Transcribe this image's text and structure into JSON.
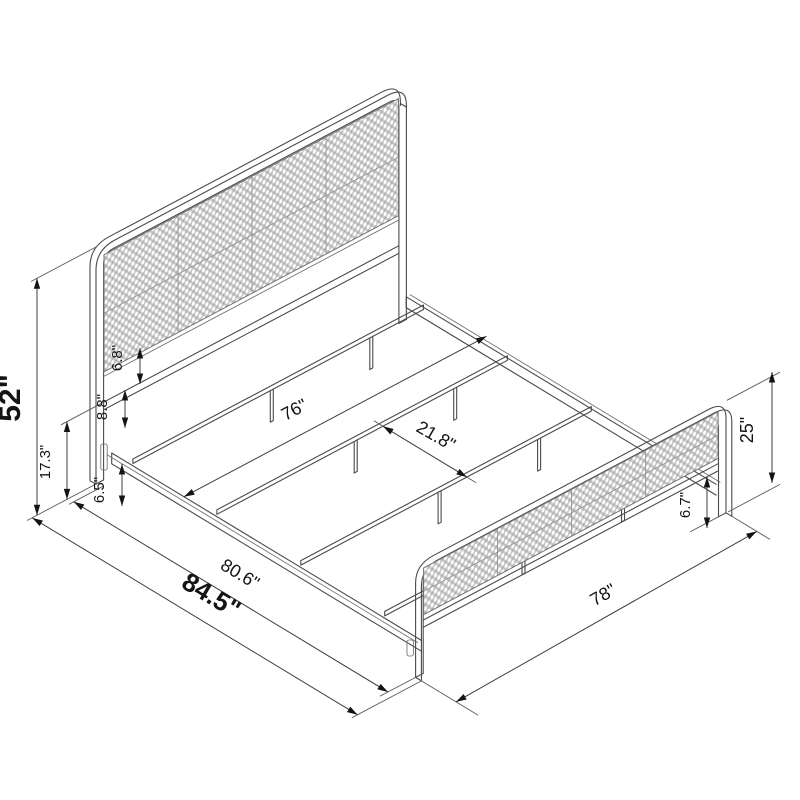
{
  "diagram": {
    "labels": {
      "headboard_height": "52\"",
      "headboard_frame_height": "17.3\"",
      "panel_to_crossbar": "6.8\"",
      "crossbar_to_rail": "8.8\"",
      "rail_height": "6.5\"",
      "inner_width": "76\"",
      "slat_spacing": "21.8\"",
      "footboard_height": "25\"",
      "footboard_panel_height": "6.7\"",
      "inner_length": "80.6\"",
      "overall_length": "84.5\"",
      "overall_width": "78\""
    },
    "colors": {
      "line": "#4a4a4a",
      "dimension": "#3d3d3d",
      "text": "#141414",
      "cane_fill": "#c5c5c5",
      "cane_hole": "#ffffff",
      "background": "#ffffff"
    }
  }
}
